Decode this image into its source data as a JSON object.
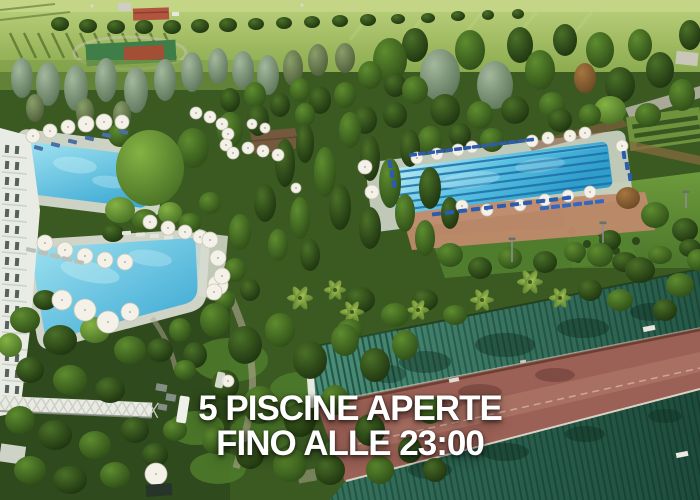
{
  "overlay": {
    "line1": "5 PISCINE APERTE",
    "line2": "FINO ALLE 23:00"
  },
  "scene": {
    "description": "Aerial drone photo of a resort hotel park with swimming pools, sun umbrellas, loungers, dense trees, a tennis court and long green metal roofs over a red terrace",
    "features": [
      "left-pool",
      "lagoon-pool",
      "olympic-lane-pool",
      "tennis-court",
      "hotel-building",
      "pergola-bridge",
      "green-roof-pavilion",
      "red-terrace",
      "gardens"
    ],
    "colors": {
      "pool_water": "#45b8dc",
      "lane_line": "#1d6fa8",
      "roof_green": "#2e6e5a",
      "terrace_red": "#9c6156",
      "field_green": "#9ab957",
      "umbrella_white": "#f3f1e8",
      "lounger_blue": "#2b5cb0",
      "text": "#ffffff"
    }
  }
}
